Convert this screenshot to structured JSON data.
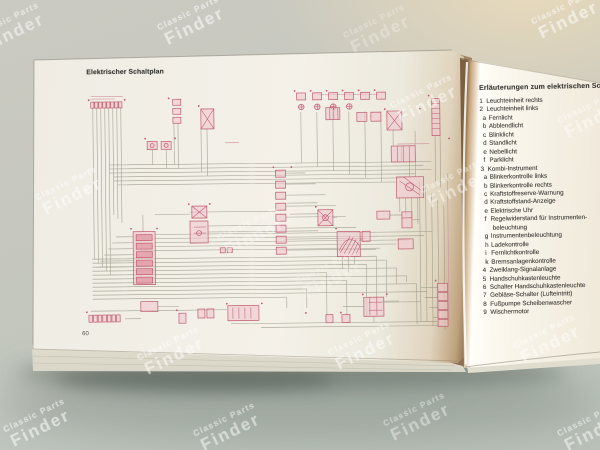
{
  "watermark": {
    "line1": "Classic Parts",
    "line2": "Finder"
  },
  "left_page": {
    "title": "Elektrischer Schaltplan",
    "page_number": "60"
  },
  "right_page": {
    "heading": "Erläuterungen zum elektrischen Schaltplan",
    "items": [
      {
        "num": "1",
        "label": "Leuchteinheit rechts",
        "level": 1
      },
      {
        "num": "2",
        "label": "Leuchteinheit links",
        "level": 1
      },
      {
        "num": "a",
        "label": "Fernlicht",
        "level": 2
      },
      {
        "num": "b",
        "label": "Abblendlicht",
        "level": 2
      },
      {
        "num": "c",
        "label": "Blinklicht",
        "level": 2
      },
      {
        "num": "d",
        "label": "Standlicht",
        "level": 2
      },
      {
        "num": "e",
        "label": "Nebellicht",
        "level": 2
      },
      {
        "num": "f",
        "label": "Parklicht",
        "level": 2
      },
      {
        "num": "3",
        "label": "Kombi-Instrument",
        "level": 1
      },
      {
        "num": "a",
        "label": "Blinkerkontrolle links",
        "level": 2
      },
      {
        "num": "b",
        "label": "Blinkerkontrolle rechts",
        "level": 2
      },
      {
        "num": "c",
        "label": "Kraftstoffreserve-Warnung",
        "level": 2
      },
      {
        "num": "d",
        "label": "Kraftstoffstand-Anzeige",
        "level": 2
      },
      {
        "num": "e",
        "label": "Elektrische Uhr",
        "level": 2
      },
      {
        "num": "f",
        "label": "Regelwiderstand für Instrumenten-",
        "level": 2
      },
      {
        "num": "",
        "label": "beleuchtung",
        "level": 3
      },
      {
        "num": "g",
        "label": "Instrumentenbeleuchtung",
        "level": 2
      },
      {
        "num": "h",
        "label": "Ladekontrolle",
        "level": 2
      },
      {
        "num": "i",
        "label": "Fernlichtkontrolle",
        "level": 2
      },
      {
        "num": "k",
        "label": "Bremsanlagenkontrolle",
        "level": 2
      },
      {
        "num": "4",
        "label": "Zweiklang-Signalanlage",
        "level": 1
      },
      {
        "num": "5",
        "label": "Handschuhkastenleuchte",
        "level": 1
      },
      {
        "num": "6",
        "label": "Schalter Handschuhkastenleuchte",
        "level": 1
      },
      {
        "num": "7",
        "label": "Gebläse-Schalter (Lufteintritt)",
        "level": 1
      },
      {
        "num": "8",
        "label": "Fußpumpe Scheibenwascher",
        "level": 1
      },
      {
        "num": "9",
        "label": "Wischermotor",
        "level": 1
      }
    ]
  },
  "colors": {
    "component_pink": "#c2566b",
    "wire_gray": "#8e8e7e",
    "page_cream": "#f4f1e9",
    "table_gray": "#c6c8bf",
    "table_beige": "#e5d8bd"
  }
}
